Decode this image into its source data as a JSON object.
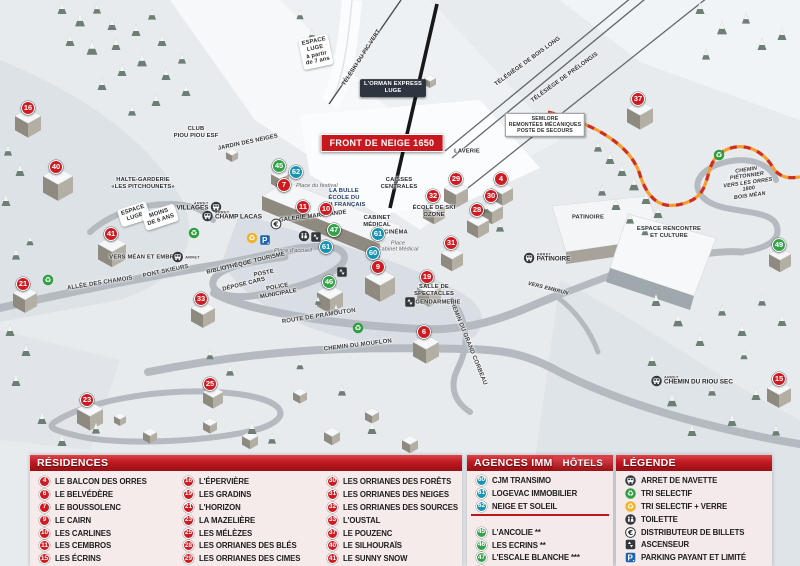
{
  "map": {
    "front_banner": "FRONT DE NEIGE 1650",
    "markers": [
      {
        "num": 16,
        "color": "red",
        "x": 28,
        "y": 108
      },
      {
        "num": 40,
        "color": "red",
        "x": 56,
        "y": 167
      },
      {
        "num": 41,
        "color": "red",
        "x": 111,
        "y": 234
      },
      {
        "num": 21,
        "color": "red",
        "x": 23,
        "y": 284
      },
      {
        "num": 33,
        "color": "red",
        "x": 201,
        "y": 299
      },
      {
        "num": 23,
        "color": "red",
        "x": 87,
        "y": 400
      },
      {
        "num": 25,
        "color": "red",
        "x": 210,
        "y": 384
      },
      {
        "num": 7,
        "color": "red",
        "x": 284,
        "y": 185
      },
      {
        "num": 11,
        "color": "red",
        "x": 303,
        "y": 207
      },
      {
        "num": 10,
        "color": "red",
        "x": 326,
        "y": 209
      },
      {
        "num": 9,
        "color": "red",
        "x": 378,
        "y": 267
      },
      {
        "num": 19,
        "color": "red",
        "x": 427,
        "y": 277
      },
      {
        "num": 6,
        "color": "red",
        "x": 424,
        "y": 332
      },
      {
        "num": 31,
        "color": "red",
        "x": 451,
        "y": 243
      },
      {
        "num": 29,
        "color": "red",
        "x": 456,
        "y": 179
      },
      {
        "num": 4,
        "color": "red",
        "x": 501,
        "y": 179
      },
      {
        "num": 32,
        "color": "red",
        "x": 433,
        "y": 196
      },
      {
        "num": 30,
        "color": "red",
        "x": 491,
        "y": 196
      },
      {
        "num": 28,
        "color": "red",
        "x": 477,
        "y": 210
      },
      {
        "num": 37,
        "color": "red",
        "x": 638,
        "y": 99
      },
      {
        "num": 15,
        "color": "red",
        "x": 779,
        "y": 379
      },
      {
        "num": 62,
        "color": "blue",
        "x": 296,
        "y": 172
      },
      {
        "num": 61,
        "color": "blue",
        "x": 326,
        "y": 247
      },
      {
        "num": 61,
        "color": "blue",
        "x": 378,
        "y": 234
      },
      {
        "num": 60,
        "color": "blue",
        "x": 373,
        "y": 253
      },
      {
        "num": 45,
        "color": "green",
        "x": 279,
        "y": 166
      },
      {
        "num": 47,
        "color": "green",
        "x": 334,
        "y": 230
      },
      {
        "num": 46,
        "color": "green",
        "x": 329,
        "y": 282
      },
      {
        "num": 49,
        "color": "green",
        "x": 779,
        "y": 245
      }
    ],
    "labels": [
      {
        "t": "ESPACE\nLUGE\nà partir\nde 7 ans",
        "x": 316,
        "y": 52,
        "r": -12,
        "c": "pill"
      },
      {
        "t": "TÉLÉSKI DU PIC VERT",
        "x": 362,
        "y": 58,
        "r": -57
      },
      {
        "t": "L'ORMAN EXPRESS\nLUGE",
        "x": 393,
        "y": 88,
        "r": 0,
        "c": "badge-dark"
      },
      {
        "t": "TÉLÉSIÈGE DE BOIS LONG",
        "x": 528,
        "y": 62,
        "r": -36
      },
      {
        "t": "TÉLÉSIÈGE DE PRÉLONGIS",
        "x": 565,
        "y": 78,
        "r": -36
      },
      {
        "t": "CLUB\nPIOU PIOU ESF",
        "x": 196,
        "y": 133,
        "r": 0
      },
      {
        "t": "JARDIN DES NEIGES",
        "x": 248,
        "y": 143,
        "r": -12
      },
      {
        "t": "HALTE-GARDERIE\n«LES PITCHOUNETS»",
        "x": 143,
        "y": 184,
        "r": 0
      },
      {
        "t": "ESPACE\nLUGE",
        "x": 134,
        "y": 214,
        "r": -18,
        "c": "pill"
      },
      {
        "t": "MOINS\nDE 6 ANS",
        "x": 160,
        "y": 217,
        "r": -18,
        "c": "pill"
      },
      {
        "t": "SEMLORE\nREMONTÉES MÉCANIQUES\nPOSTE DE SECOURS",
        "x": 545,
        "y": 125,
        "r": 0,
        "c": "box-white"
      },
      {
        "t": "LAVERIE",
        "x": 467,
        "y": 152,
        "r": 0
      },
      {
        "t": "CAISSES\nCENTRALES",
        "x": 399,
        "y": 184,
        "r": 0
      },
      {
        "t": "Place du festival",
        "x": 317,
        "y": 186,
        "r": 0,
        "c": "it"
      },
      {
        "t": "LA BULLE\nÉCOLE DU\nSKI FRANÇAIS",
        "x": 344,
        "y": 198,
        "r": 0,
        "c": "navy"
      },
      {
        "t": "ÉCOLE DE SKI\nOZONE",
        "x": 434,
        "y": 212,
        "r": 0
      },
      {
        "t": "GALERIE MARCHANDE",
        "x": 313,
        "y": 217,
        "r": -7
      },
      {
        "t": "CABINET\nMÉDICAL",
        "x": 377,
        "y": 222,
        "r": 0
      },
      {
        "t": "CINÉMA",
        "x": 396,
        "y": 233,
        "r": 0
      },
      {
        "t": "Place\nCabinet Médical",
        "x": 398,
        "y": 247,
        "r": 0,
        "c": "it"
      },
      {
        "t": "Place d'accueil",
        "x": 293,
        "y": 251,
        "r": 0,
        "c": "it"
      },
      {
        "t": "OFFICE DE TOURISME",
        "x": 253,
        "y": 262,
        "r": -13
      },
      {
        "t": "BIBLIOTHÈQUE",
        "x": 229,
        "y": 268,
        "r": -13
      },
      {
        "t": "POSTE",
        "x": 264,
        "y": 274,
        "r": -11
      },
      {
        "t": "DÉPOSE CARS",
        "x": 244,
        "y": 285,
        "r": -14
      },
      {
        "t": "POLICE\nMUNICIPALE",
        "x": 278,
        "y": 291,
        "r": -10
      },
      {
        "t": "VERS MÉAN ET EMBRUN",
        "x": 146,
        "y": 258,
        "r": 0
      },
      {
        "t": "PONT SKIEURS",
        "x": 166,
        "y": 272,
        "r": -12,
        "c": "road"
      },
      {
        "t": "ALLÉE DES CHAMOIS",
        "x": 100,
        "y": 284,
        "r": -9,
        "c": "road"
      },
      {
        "t": "ROUTE DE PRAMOUTON",
        "x": 319,
        "y": 317,
        "r": -9,
        "c": "road"
      },
      {
        "t": "CHEMIN DU MOUFLON",
        "x": 358,
        "y": 346,
        "r": -7,
        "c": "road"
      },
      {
        "t": "CHEMIN DU GRAND CORBEAU",
        "x": 467,
        "y": 342,
        "r": 68,
        "c": "road"
      },
      {
        "t": "SALLE DE\nSPECTACLES",
        "x": 434,
        "y": 291,
        "r": 0
      },
      {
        "t": "GENDARMERIE",
        "x": 438,
        "y": 303,
        "r": 0
      },
      {
        "t": "PATINOIRE",
        "x": 588,
        "y": 218,
        "r": 0
      },
      {
        "t": "ESPACE RENCONTRE\nET CULTURE",
        "x": 669,
        "y": 233,
        "r": 0
      },
      {
        "t": "VERS EMBRUN",
        "x": 548,
        "y": 289,
        "r": 14,
        "c": "itb"
      },
      {
        "t": "CHEMIN PIÉTONNIER\nVERS LES ORRES 1800\nBOIS MÉAN",
        "x": 748,
        "y": 183,
        "r": -8,
        "c": "itb"
      }
    ],
    "bus_stops": [
      {
        "arret": "ARRET",
        "name": "VILLAGES",
        "x": 199,
        "y": 207,
        "side": "left"
      },
      {
        "arret": "ARRET",
        "name": "CHAMP LACAS",
        "x": 232,
        "y": 216,
        "side": "right"
      },
      {
        "arret": "ARRET",
        "name": "",
        "x": 186,
        "y": 257,
        "side": "right"
      },
      {
        "arret": "ARRET",
        "name": "PATINOIRE",
        "x": 547,
        "y": 258,
        "side": "right"
      },
      {
        "arret": "ARRET",
        "name": "CHEMIN DU RIOU SEC",
        "x": 692,
        "y": 381,
        "side": "right"
      }
    ],
    "icons": [
      {
        "type": "tri",
        "x": 194,
        "y": 233
      },
      {
        "type": "tri",
        "x": 48,
        "y": 280
      },
      {
        "type": "tri",
        "x": 358,
        "y": 328
      },
      {
        "type": "tri",
        "x": 719,
        "y": 155
      },
      {
        "type": "tri-verre",
        "x": 252,
        "y": 238
      },
      {
        "type": "parking",
        "x": 265,
        "y": 240
      },
      {
        "type": "euro",
        "x": 276,
        "y": 224
      },
      {
        "type": "toilette",
        "x": 304,
        "y": 236
      },
      {
        "type": "ascenseur",
        "x": 316,
        "y": 237
      },
      {
        "type": "ascenseur",
        "x": 342,
        "y": 272
      },
      {
        "type": "ascenseur",
        "x": 410,
        "y": 302
      }
    ]
  },
  "legend": {
    "residences": {
      "title": "RÉSIDENCES",
      "items": [
        {
          "num": 4,
          "label": "LE BALCON DES ORRES"
        },
        {
          "num": 6,
          "label": "LE BELVÉDÈRE"
        },
        {
          "num": 7,
          "label": "LE BOUSSOLENC"
        },
        {
          "num": 9,
          "label": "LE CAIRN"
        },
        {
          "num": 10,
          "label": "LES CARLINES"
        },
        {
          "num": 11,
          "label": "LES CEMBROS"
        },
        {
          "num": 15,
          "label": "LES ÉCRINS"
        },
        {
          "num": 16,
          "label": "L'ÉPERVIÈRE"
        },
        {
          "num": 19,
          "label": "LES GRADINS"
        },
        {
          "num": 21,
          "label": "L'HORIZON"
        },
        {
          "num": 23,
          "label": "LA MAZELIÈRE"
        },
        {
          "num": 25,
          "label": "LES MÉLÈZES"
        },
        {
          "num": 28,
          "label": "LES ORRIANES DES BLÉS"
        },
        {
          "num": 29,
          "label": "LES ORRIANES DES CIMES"
        },
        {
          "num": 30,
          "label": "LES ORRIANES DES FORÊTS"
        },
        {
          "num": 31,
          "label": "LES ORRIANES DES NEIGES"
        },
        {
          "num": 32,
          "label": "LES ORRIANES DES SOURCES"
        },
        {
          "num": 33,
          "label": "L'OUSTAL"
        },
        {
          "num": 37,
          "label": "LE POUZENC"
        },
        {
          "num": 40,
          "label": "LE SILHOURAÏS"
        },
        {
          "num": 41,
          "label": "LE SUNNY SNOW"
        }
      ]
    },
    "agences": {
      "title": "AGENCES IMMOBILIÈRES",
      "items": [
        {
          "num": 60,
          "label": "CJM TRANSIMO"
        },
        {
          "num": 61,
          "label": "LOGEVAC IMMOBILIER"
        },
        {
          "num": 62,
          "label": "NEIGE ET SOLEIL"
        }
      ]
    },
    "hotels": {
      "title": "HÔTELS",
      "items": [
        {
          "num": 45,
          "label": "L'ANCOLIE **"
        },
        {
          "num": 46,
          "label": "LES ECRINS **"
        },
        {
          "num": 47,
          "label": "L'ESCALE BLANCHE ***"
        },
        {
          "num": 49,
          "label": "LES TRAPPEURS **"
        }
      ]
    },
    "legende": {
      "title": "LÉGENDE",
      "items": [
        {
          "icon": "bus",
          "label": "ARRET DE NAVETTE"
        },
        {
          "icon": "tri",
          "label": "TRI SELECTIF"
        },
        {
          "icon": "tri-verre",
          "label": "TRI SELECTIF + VERRE"
        },
        {
          "icon": "toilette",
          "label": "TOILETTE"
        },
        {
          "icon": "euro",
          "label": "DISTRIBUTEUR DE BILLETS"
        },
        {
          "icon": "ascenseur",
          "label": "ASCENSEUR"
        },
        {
          "icon": "parking",
          "label": "PARKING PAYANT ET LIMITÉ"
        }
      ]
    }
  },
  "colors": {
    "residence": "#cf1a22",
    "agence": "#1793b4",
    "hotel": "#33a348",
    "header_red": "#b5161d",
    "trail_orange": "#f59f2e",
    "trail_red": "#cf2e24"
  }
}
